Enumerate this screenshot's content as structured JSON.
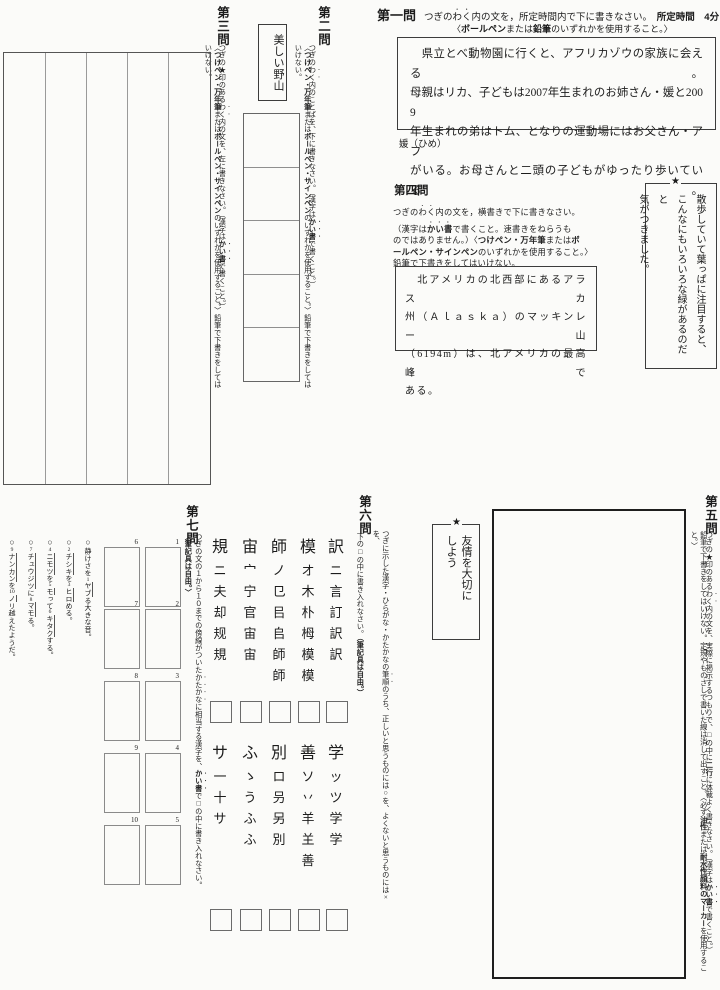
{
  "q1": {
    "number": "第一問",
    "instruction_segments": [
      {
        "t": "つぎの"
      },
      {
        "t": "わく",
        "e": 1
      },
      {
        "t": "内の文を，所定時間内で下に書きなさい。"
      },
      {
        "t": "　所定時間　4分",
        "b": 1
      }
    ],
    "tool_segments": [
      {
        "t": "〈"
      },
      {
        "t": "ボールペン",
        "b": 1
      },
      {
        "t": "または"
      },
      {
        "t": "鉛筆",
        "b": 1
      },
      {
        "t": "のいずれかを使用すること。〉"
      }
    ],
    "box_lines": [
      "　県立とべ動物園に行くと、アフリカゾウの家族に会える。",
      "母親はリカ、子どもは2007年生まれのお姉さん・媛と2009",
      "年生まれの弟はトム、となりの運動場にはお父さん・アフ",
      "がいる。お母さんと二頭の子どもがゆったり歩いている。"
    ],
    "note": "媛（ひめ）"
  },
  "q2": {
    "number": "第二問",
    "inst1_segments": [
      {
        "t": "つぎの"
      },
      {
        "t": "わく",
        "e": 1
      },
      {
        "t": "内のことばを、下に書きなさい。（漢字は"
      },
      {
        "t": "かい書",
        "b": 1,
        "e": 1
      },
      {
        "t": "で書くこと。）"
      }
    ],
    "inst2_segments": [
      {
        "t": "〈"
      },
      {
        "t": "つけペン・万年筆",
        "b": 1
      },
      {
        "t": "または"
      },
      {
        "t": "ボールペン・サインペン",
        "b": 1
      },
      {
        "t": "のいずれかを使用すること。〉鉛筆で下書きをしてはいけない。"
      }
    ],
    "sample": "美しい野山"
  },
  "q3": {
    "number": "第三問",
    "inst1_segments": [
      {
        "t": "つぎの★印のある"
      },
      {
        "t": "わく",
        "e": 1
      },
      {
        "t": "内の文を、左に書きなさい。（漢字は"
      },
      {
        "t": "かい書",
        "b": 1,
        "e": 1
      },
      {
        "t": "で書くこと。）"
      }
    ],
    "inst2_segments": [
      {
        "t": "〈"
      },
      {
        "t": "つけペン・万年筆",
        "b": 1
      },
      {
        "t": "または"
      },
      {
        "t": "ボールペン・サインペン",
        "b": 1
      },
      {
        "t": "のいずれかを使用すること。〉鉛筆で下書きをしてはいけない。"
      }
    ]
  },
  "q4": {
    "number": "第四問",
    "inst_segments": [
      {
        "t": "つぎの"
      },
      {
        "t": "わく",
        "e": 1
      },
      {
        "t": "内の文を，横書きで下に書きなさい。\n（漢字は"
      },
      {
        "t": "かい書",
        "b": 1,
        "e": 1
      },
      {
        "t": "で書くこと。速書きをねらうも\nのではありません。）〈"
      },
      {
        "t": "つけペン・万年筆",
        "b": 1
      },
      {
        "t": "または"
      },
      {
        "t": "ボ\nールペン・サインペン",
        "b": 1
      },
      {
        "t": "のいずれかを使用すること。〉\n鉛筆で下書きをしてはいけない。"
      }
    ],
    "box_lines": [
      "　北アメリカの北西部にあるアラスカ",
      "州（Ａｌａｓｋａ）のマッキンレー山",
      "（6194m）は、北アメリカの最高峰で",
      "ある。"
    ],
    "star_box": {
      "star": "★",
      "columns": [
        "散歩していて葉っぱに注目すると、",
        "こんなにもいろいろな緑があるのだと",
        "気がつきました。"
      ]
    }
  },
  "q5": {
    "number": "第五問",
    "inst1_segments": [
      {
        "t": "つぎの★印のある"
      },
      {
        "t": "わく",
        "e": 1
      },
      {
        "t": "内の文を、実際に掲示するつもりで、□の中に"
      },
      {
        "t": "二行",
        "b": 1
      },
      {
        "t": "に体裁よく書きなさい。（漢字は"
      },
      {
        "t": "かい書",
        "b": 1,
        "e": 1
      },
      {
        "t": "で書くこと。）"
      }
    ],
    "inst2_segments": [
      {
        "t": "鉛筆で下書きをしてはいけない。定規やものさしで書いた線は消して出すこと。〈必ず"
      },
      {
        "t": "油性",
        "b": 1
      },
      {
        "t": "または"
      },
      {
        "t": "耐水性顔料のマーカー",
        "b": 1
      },
      {
        "t": "を使用すること。〉"
      }
    ],
    "star_box": {
      "star": "★",
      "columns": [
        "友情を大切に",
        "しよう"
      ]
    }
  },
  "q6": {
    "number": "第六問",
    "inst1_segments": [
      {
        "t": "つぎに示した漢字・ひらがな・かたかなの"
      },
      {
        "t": "筆順",
        "e": 1
      },
      {
        "t": "のうち、正しいと思うものには○を、よくないと思うものには×を、"
      }
    ],
    "inst2_segments": [
      {
        "t": "下の□の中に書き入れなさい。"
      },
      {
        "t": "（筆記具は自由。）",
        "b": 1
      }
    ],
    "top": [
      {
        "char": "訳",
        "steps": [
          "ニ",
          "言",
          "訂",
          "訳",
          "訳"
        ]
      },
      {
        "char": "模",
        "steps": [
          "オ",
          "木",
          "朴",
          "栂",
          "模",
          "模"
        ]
      },
      {
        "char": "師",
        "steps": [
          "ノ",
          "㔾",
          "㠯",
          "𠂤",
          "師",
          "師"
        ]
      },
      {
        "char": "宙",
        "steps": [
          "宀",
          "宁",
          "官",
          "宙",
          "宙"
        ]
      },
      {
        "char": "規",
        "steps": [
          "ニ",
          "夫",
          "却",
          "规",
          "規"
        ]
      }
    ],
    "bottom": [
      {
        "char": "学",
        "steps": [
          "ッ",
          "ツ",
          "学",
          "学"
        ]
      },
      {
        "char": "善",
        "steps": [
          "ソ",
          "丷",
          "羊",
          "𦍌",
          "善"
        ]
      },
      {
        "char": "別",
        "steps": [
          "ロ",
          "叧",
          "另",
          "別"
        ]
      },
      {
        "char": "ふ",
        "steps": [
          "ゝ",
          "う",
          "ふ",
          "ふ"
        ]
      },
      {
        "char": "サ",
        "steps": [
          "一",
          "十",
          "サ"
        ]
      }
    ]
  },
  "q7": {
    "number": "第七問",
    "inst_segments": [
      {
        "t": "つぎの文の１から１０までの傍線がついた"
      },
      {
        "t": "かたかな",
        "e": 1
      },
      {
        "t": "に相当する漢字を、"
      },
      {
        "t": "かい書",
        "b": 1,
        "e": 1
      },
      {
        "t": "で□の中に書き入れなさい。"
      },
      {
        "t": "〈筆記具は自由。〉",
        "b": 1
      }
    ],
    "right_numbers": [
      "1",
      "2",
      "3",
      "4",
      "5"
    ],
    "left_numbers": [
      "6",
      "7",
      "8",
      "9",
      "10"
    ],
    "sentences": [
      [
        {
          "t": "○",
          "cls": "circ"
        },
        {
          "t": "静けさを"
        },
        {
          "n": "1"
        },
        {
          "t": "ヤブ",
          "u": 1
        },
        {
          "t": "る大きな音。"
        }
      ],
      [
        {
          "t": "○",
          "cls": "circ"
        },
        {
          "n": "2"
        },
        {
          "t": "チシキ",
          "u": 1
        },
        {
          "t": "を"
        },
        {
          "n": "3"
        },
        {
          "t": "ヒロ",
          "u": 1
        },
        {
          "t": "める。"
        }
      ],
      [
        {
          "t": "○",
          "cls": "circ"
        },
        {
          "n": "4"
        },
        {
          "t": "ニモツ",
          "u": 1
        },
        {
          "t": "を"
        },
        {
          "n": "5"
        },
        {
          "t": "モ",
          "u": 1
        },
        {
          "t": "って"
        },
        {
          "n": "6"
        },
        {
          "t": "キタク",
          "u": 1
        },
        {
          "t": "する。"
        }
      ],
      [
        {
          "t": "○",
          "cls": "circ"
        },
        {
          "n": "7"
        },
        {
          "t": "チュウジツ",
          "u": 1
        },
        {
          "t": "に"
        },
        {
          "n": "8"
        },
        {
          "t": "マモ",
          "u": 1
        },
        {
          "t": "る。"
        }
      ],
      [
        {
          "t": "○",
          "cls": "circ"
        },
        {
          "n": "9"
        },
        {
          "t": "ナンカン",
          "u": 1
        },
        {
          "t": "を"
        },
        {
          "n": "10"
        },
        {
          "t": "ノ",
          "u": 1
        },
        {
          "t": "リ越えたようだ。"
        }
      ]
    ]
  }
}
